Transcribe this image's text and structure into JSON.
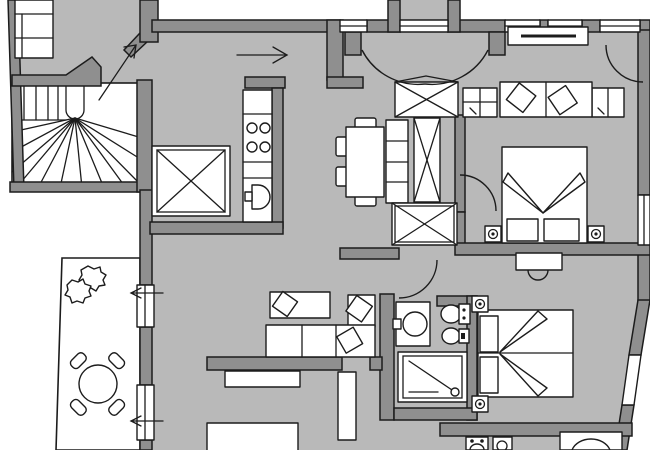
{
  "meta": {
    "title": "Apartment floor plan",
    "description": "Black, white and grey architectural furnished floor plan of an apartment with balcony, winding stairwell, kitchen, dining area, living room, two bedrooms and two bathrooms. No text labels are printed on the drawing.",
    "width_px": 650,
    "height_px": 450
  },
  "colors": {
    "outside": "#ffffff",
    "floor": "#b9b9b9",
    "wall": "#8f8f8f",
    "line": "#1c1c1c",
    "furniture": "#ffffff"
  },
  "annotations": {
    "arrows": [
      {
        "name": "stair-entry-arrow",
        "direction": "north-east",
        "meaning": "route from stairwell into apartment entry hall"
      },
      {
        "name": "hallway-arrow",
        "direction": "east",
        "meaning": "route along entry hallway into main rooms"
      },
      {
        "name": "balcony-door-arrow-upper",
        "direction": "west",
        "meaning": "door opens to balcony"
      },
      {
        "name": "balcony-door-arrow-lower",
        "direction": "west",
        "meaning": "door opens to balcony"
      }
    ]
  },
  "rooms": [
    {
      "id": "stairwell",
      "label": "communal stairwell",
      "items": [
        {
          "name": "winding-staircase",
          "qty": 1
        },
        {
          "name": "straight-stair-flight",
          "qty": 1
        }
      ]
    },
    {
      "id": "entry-hall",
      "label": "entry hall / landing",
      "items": [
        {
          "name": "wall-shelving-unit",
          "qty": 1
        },
        {
          "name": "closet-or-lift-box-x",
          "qty": 1
        }
      ]
    },
    {
      "id": "vestibule",
      "label": "entrance vestibule",
      "items": [
        {
          "name": "entrance-threshold",
          "qty": 1
        },
        {
          "name": "double-swing-doors",
          "qty": 1
        }
      ]
    },
    {
      "id": "kitchen",
      "label": "kitchen nook",
      "items": [
        {
          "name": "kitchen-counter",
          "qty": 1
        },
        {
          "name": "stove-burner",
          "qty": 4
        },
        {
          "name": "kitchen-sink",
          "qty": 1
        }
      ]
    },
    {
      "id": "dining-room",
      "label": "dining / great room",
      "items": [
        {
          "name": "dining-table",
          "qty": 1
        },
        {
          "name": "dining-chair",
          "qty": 4
        },
        {
          "name": "open-shelf-column",
          "qty": 1
        },
        {
          "name": "wardrobe-x-tall",
          "qty": 1
        },
        {
          "name": "wardrobe-x-top",
          "qty": 1
        },
        {
          "name": "wardrobe-x-corridor",
          "qty": 1
        }
      ]
    },
    {
      "id": "bedroom-1",
      "label": "bedroom 1 (top right)",
      "items": [
        {
          "name": "double-bed",
          "qty": 1
        },
        {
          "name": "bed-pillow",
          "qty": 2
        },
        {
          "name": "sofa",
          "qty": 1
        },
        {
          "name": "sofa-cushion",
          "qty": 2
        },
        {
          "name": "side-cabinet",
          "qty": 2
        },
        {
          "name": "desk-under-window",
          "qty": 1
        },
        {
          "name": "bedside-lamp",
          "qty": 2
        },
        {
          "name": "window",
          "qty": 3
        },
        {
          "name": "french-door-arc",
          "qty": 1
        }
      ]
    },
    {
      "id": "bedroom-2",
      "label": "bedroom 2 (bottom right)",
      "items": [
        {
          "name": "double-bed",
          "qty": 1
        },
        {
          "name": "bed-pillow",
          "qty": 2
        },
        {
          "name": "bedside-lamp",
          "qty": 2
        },
        {
          "name": "radiator",
          "qty": 1
        },
        {
          "name": "window",
          "qty": 2
        }
      ]
    },
    {
      "id": "bathroom-1",
      "label": "bathroom with shower",
      "items": [
        {
          "name": "washbasin",
          "qty": 1
        },
        {
          "name": "toilet",
          "qty": 1
        },
        {
          "name": "bidet",
          "qty": 1
        },
        {
          "name": "shower-tray",
          "qty": 1
        }
      ]
    },
    {
      "id": "bathroom-2",
      "label": "bathroom with bathtub (cut at bottom edge)",
      "items": [
        {
          "name": "toilet",
          "qty": 1
        },
        {
          "name": "bidet",
          "qty": 1
        },
        {
          "name": "bathtub",
          "qty": 1
        }
      ]
    },
    {
      "id": "living-room",
      "label": "living room",
      "items": [
        {
          "name": "chaise-longue",
          "qty": 1
        },
        {
          "name": "corner-sofa",
          "qty": 1
        },
        {
          "name": "sofa-cushion",
          "qty": 3
        },
        {
          "name": "sideboard",
          "qty": 1
        },
        {
          "name": "rug",
          "qty": 1
        },
        {
          "name": "partition-half-wall",
          "qty": 1
        },
        {
          "name": "open-door-leaf",
          "qty": 1
        }
      ]
    },
    {
      "id": "balcony",
      "label": "balcony / terrace",
      "items": [
        {
          "name": "plant",
          "qty": 2
        },
        {
          "name": "round-table",
          "qty": 1
        },
        {
          "name": "balcony-chair",
          "qty": 4
        },
        {
          "name": "french-door",
          "qty": 2
        }
      ]
    }
  ]
}
